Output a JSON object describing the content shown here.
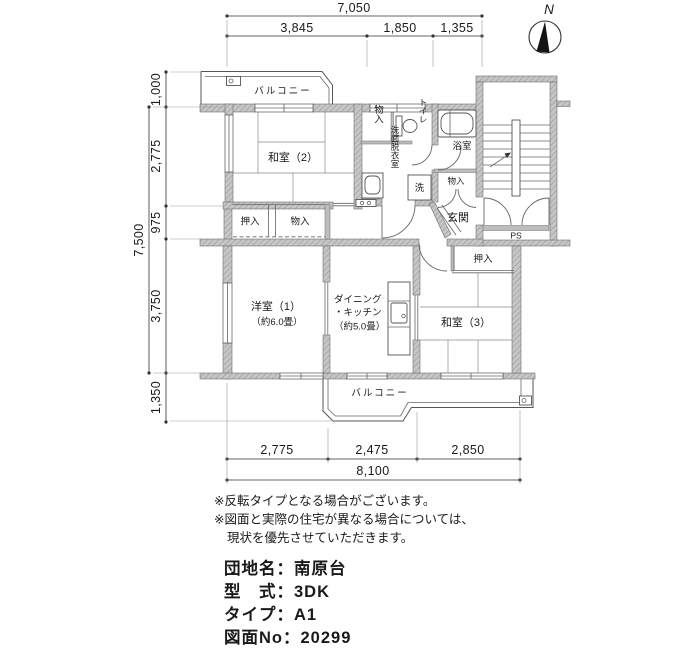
{
  "compass": {
    "north_label": "N"
  },
  "dimensions": {
    "top": {
      "total": "7,050",
      "segments": [
        "3,845",
        "1,850",
        "1,355"
      ]
    },
    "left": {
      "total": "7,500",
      "segments": [
        "1,000",
        "2,775",
        "975",
        "3,750",
        "1,350"
      ]
    },
    "bottom": {
      "total": "8,100",
      "segments": [
        "2,775",
        "2,475",
        "2,850"
      ]
    }
  },
  "rooms": {
    "balcony_top": "バルコニー",
    "balcony_bottom": "バルコニー",
    "washitsu2": "和室（2）",
    "storage_top": "物入",
    "toilet": "トイレ",
    "washroom": "洗面脱衣室",
    "laundry": "洗",
    "bath": "浴室",
    "storage_entry": "物入",
    "entry": "玄関",
    "pipe_space": "PS",
    "closet_mid": "押入",
    "storage_mid": "物入",
    "yoshitsu1_name": "洋室（1）",
    "yoshitsu1_size": "（約6.0畳）",
    "dk_line1": "ダイニング",
    "dk_line2": "・キッチン",
    "dk_size": "（約5.0畳）",
    "washitsu3": "和室（3）",
    "closet3": "押入"
  },
  "notes": [
    "※反転タイプとなる場合がございます。",
    "※図面と実際の住宅が異なる場合については、",
    "現状を優先させていただきます。"
  ],
  "info": {
    "lines": [
      {
        "label": "団地名：",
        "value": "南原台"
      },
      {
        "label": "型　式：",
        "value": "3DK"
      },
      {
        "label": "タイプ：",
        "value": "A1"
      },
      {
        "label": "図面No：",
        "value": "20299"
      }
    ]
  }
}
